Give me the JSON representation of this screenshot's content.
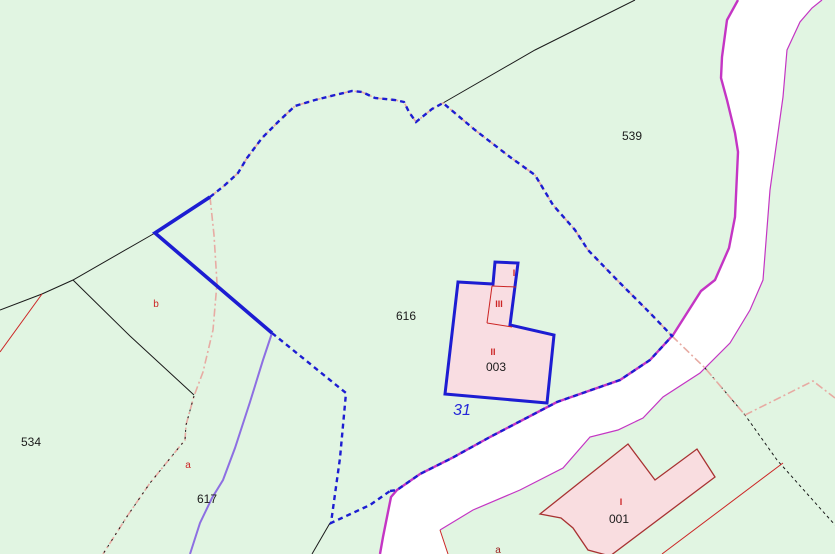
{
  "map": {
    "background_color": "#e1f5e2",
    "road_fill": "#ffffff",
    "colors": {
      "selected_boundary_blue": "#1d1dd2",
      "road_edge_magenta": "#c435c4",
      "violet_boundary": "#8d6fe2",
      "salmon_boundary": "#e7aba3",
      "black_boundary": "#1a1a1a",
      "red_detail": "#cc2525",
      "building_outline": "#a83232",
      "building_fill": "#f9dde0",
      "selected_building_fill": "#f9dde2",
      "label_black": "#1b1b1b",
      "label_red": "#cc2525",
      "label_dark_red": "#9b1d1d",
      "address_blue": "#2626d8"
    },
    "labels": {
      "parcel_539": "539",
      "parcel_616": "616",
      "parcel_534": "534",
      "parcel_617": "617",
      "subdivision_b": "b",
      "subdivision_a": "a",
      "subdivision_a_south": "a",
      "building_003_number": "003",
      "building_003_section_1": "I",
      "building_003_section_2": "II",
      "building_003_section_3": "III",
      "building_001_number": "001",
      "building_001_section_1": "I",
      "address_31": "31"
    }
  }
}
